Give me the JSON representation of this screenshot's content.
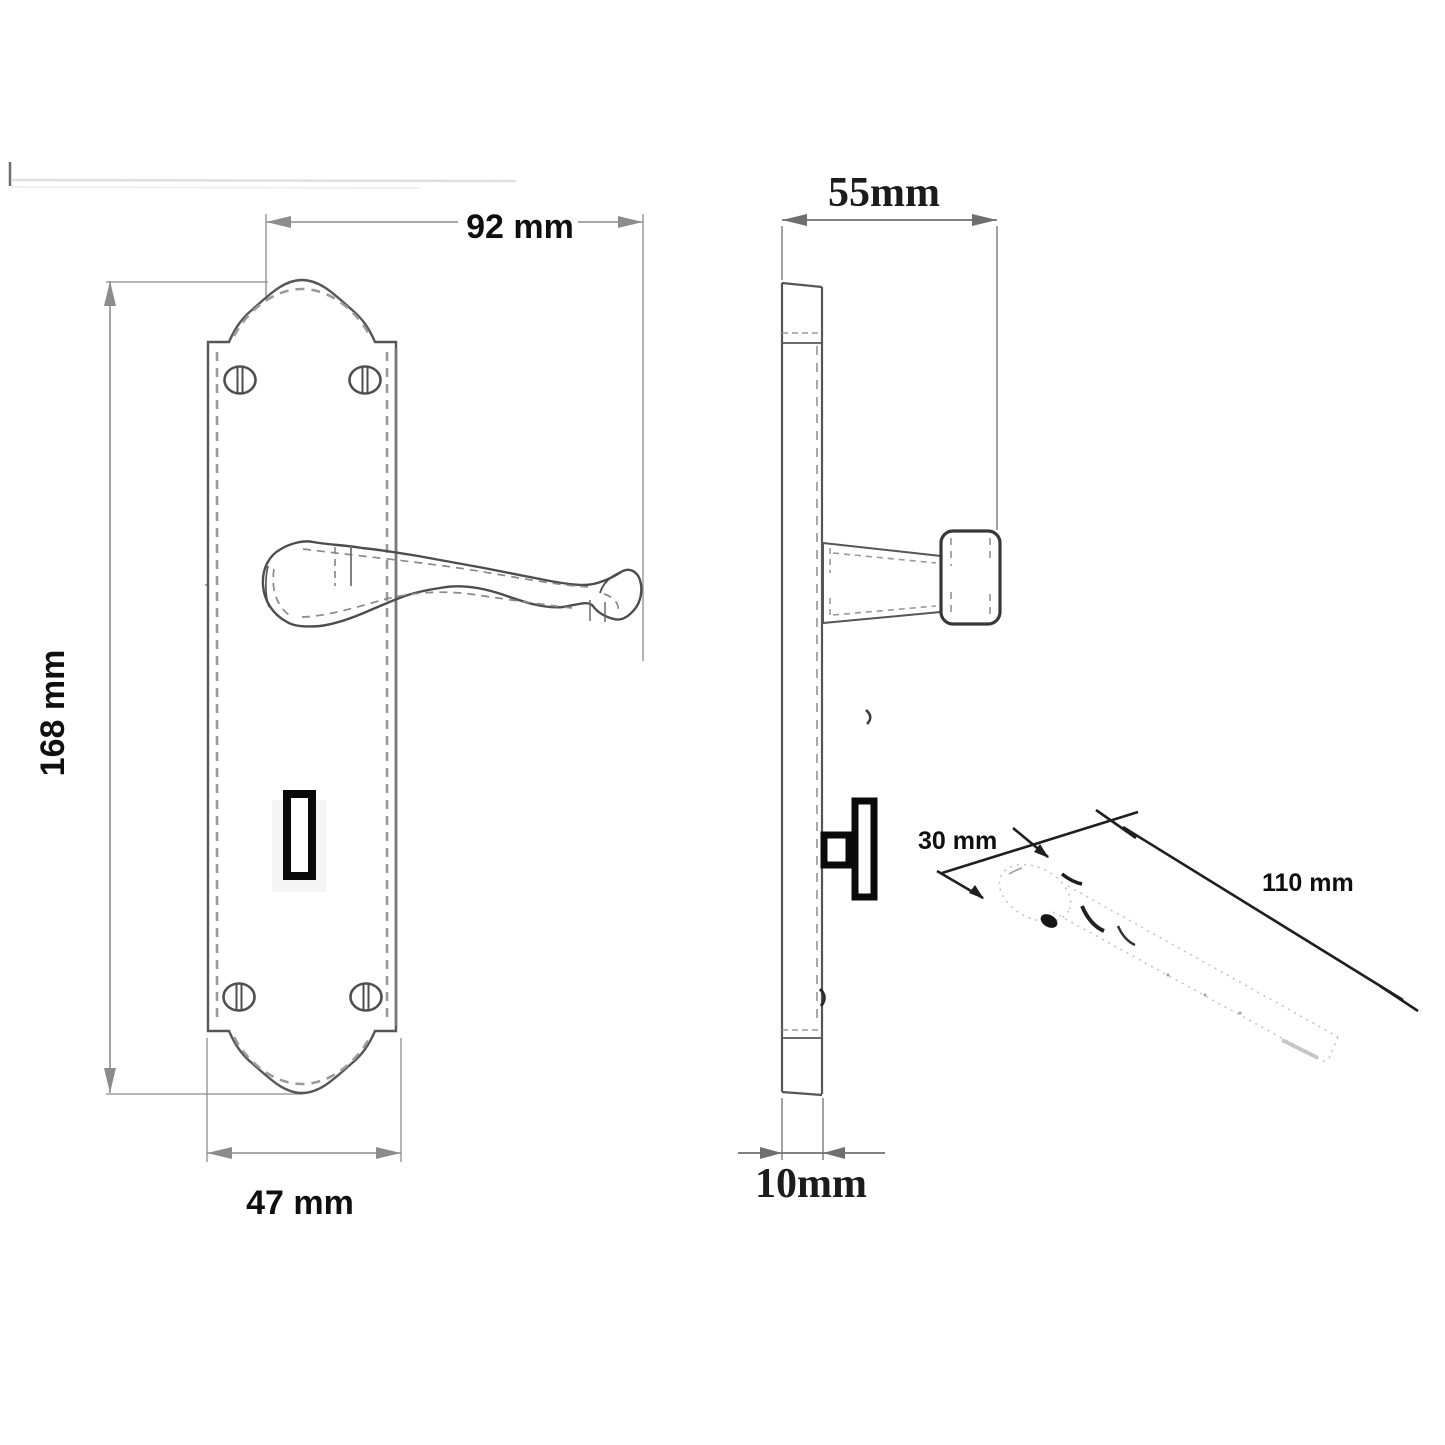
{
  "document": {
    "type": "technical-drawing",
    "subject": "Lever door handle on backplate with keyhole, spindle - dimensioned views"
  },
  "colors": {
    "background": "#ffffff",
    "outline": "#565656",
    "dashed": "#9a9a9a",
    "dimension_line": "#8c8c8c",
    "annotation_dark": "#222222",
    "black_detail": "#0a0a0a",
    "artifact_line": "#e3dede"
  },
  "views": {
    "front": {
      "name": "front-elevation",
      "features": [
        "arched backplate",
        "4 screws",
        "scroll lever handle",
        "keyhole slot"
      ],
      "dimensions": [
        {
          "id": "overall-projection-width",
          "value": "92 mm"
        },
        {
          "id": "plate-height",
          "value": "168 mm"
        },
        {
          "id": "plate-width",
          "value": "47 mm"
        }
      ]
    },
    "side": {
      "name": "side-profile",
      "features": [
        "plate edge",
        "lever neck and grip end-on",
        "thumbturn"
      ],
      "dimensions": [
        {
          "id": "total-projection",
          "value": "55mm"
        },
        {
          "id": "plate-thickness",
          "value": "10mm"
        }
      ]
    },
    "spindle": {
      "name": "spindle-perspective",
      "features": [
        "faint isometric spindle bar"
      ],
      "dimensions": [
        {
          "id": "spindle-first-section",
          "value": "30 mm"
        },
        {
          "id": "spindle-length",
          "value": "110 mm"
        }
      ]
    }
  },
  "labels": {
    "dim_92": "92 mm",
    "dim_168": "168 mm",
    "dim_47": "47 mm",
    "dim_55": "55mm",
    "dim_10": "10mm",
    "dim_30": "30 mm",
    "dim_110": "110 mm"
  }
}
